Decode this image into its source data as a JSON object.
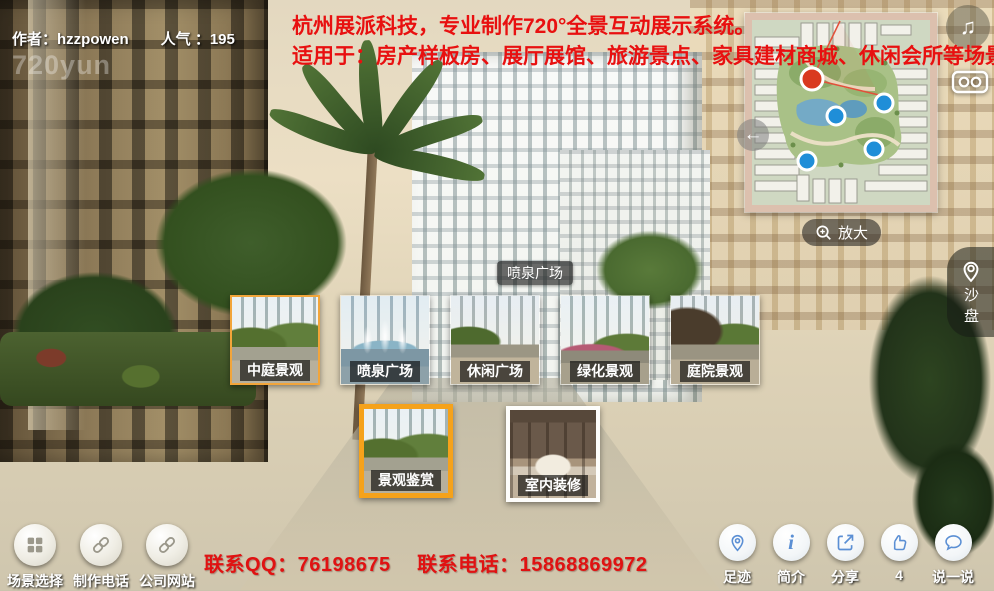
{
  "colors": {
    "banner_red": "#e81010",
    "accent_orange": "#f5a21b",
    "marker_red": "#d93a20",
    "marker_blue": "#1f8ed8",
    "icon_blue": "#5b8fd4"
  },
  "header": {
    "author": "作者：hzzpowen",
    "popularity": "人气 ：195",
    "watermark": "720yun",
    "banner_line1": "杭州展派科技，专业制作720°全景互动展示系统。",
    "banner_line2": "适用于：房产样板房、展厅展馆、旅游景点、家具建材商城、休闲会所等场景宣传展示"
  },
  "minimap": {
    "zoom_button_label": "放大",
    "markers": {
      "current_location": 1,
      "scene_markers": 4
    }
  },
  "right_toolbar": {
    "music_icon": "♫",
    "vr_icon": "vr-goggles",
    "sandbox": {
      "icon": "map-pin",
      "label": "沙盘"
    }
  },
  "hotspot_label": "喷泉广场",
  "thumbnails": {
    "row1": [
      {
        "label": "中庭景观",
        "highlighted": true
      },
      {
        "label": "喷泉广场",
        "highlighted": false
      },
      {
        "label": "休闲广场",
        "highlighted": false
      },
      {
        "label": "绿化景观",
        "highlighted": false
      },
      {
        "label": "庭院景观",
        "highlighted": false
      }
    ],
    "row2": [
      {
        "label": "景观鉴赏",
        "highlighted": true
      },
      {
        "label": "室内装修",
        "highlighted": false
      }
    ]
  },
  "bottom_left_toolbar": {
    "items": [
      {
        "label": "场景选择",
        "icon": "grid-icon"
      },
      {
        "label": "制作电话",
        "icon": "link-icon"
      },
      {
        "label": "公司网站",
        "icon": "link-icon"
      }
    ]
  },
  "contact_line": "联系QQ：76198675　 联系电话：15868869972",
  "bottom_right_toolbar": {
    "items": [
      {
        "label": "足迹",
        "icon": "pin-icon"
      },
      {
        "label": "简介",
        "icon": "info-icon"
      },
      {
        "label": "分享",
        "icon": "share-icon"
      },
      {
        "label": "4",
        "icon": "thumbs-up-icon"
      },
      {
        "label": "说一说",
        "icon": "speech-icon"
      }
    ]
  }
}
